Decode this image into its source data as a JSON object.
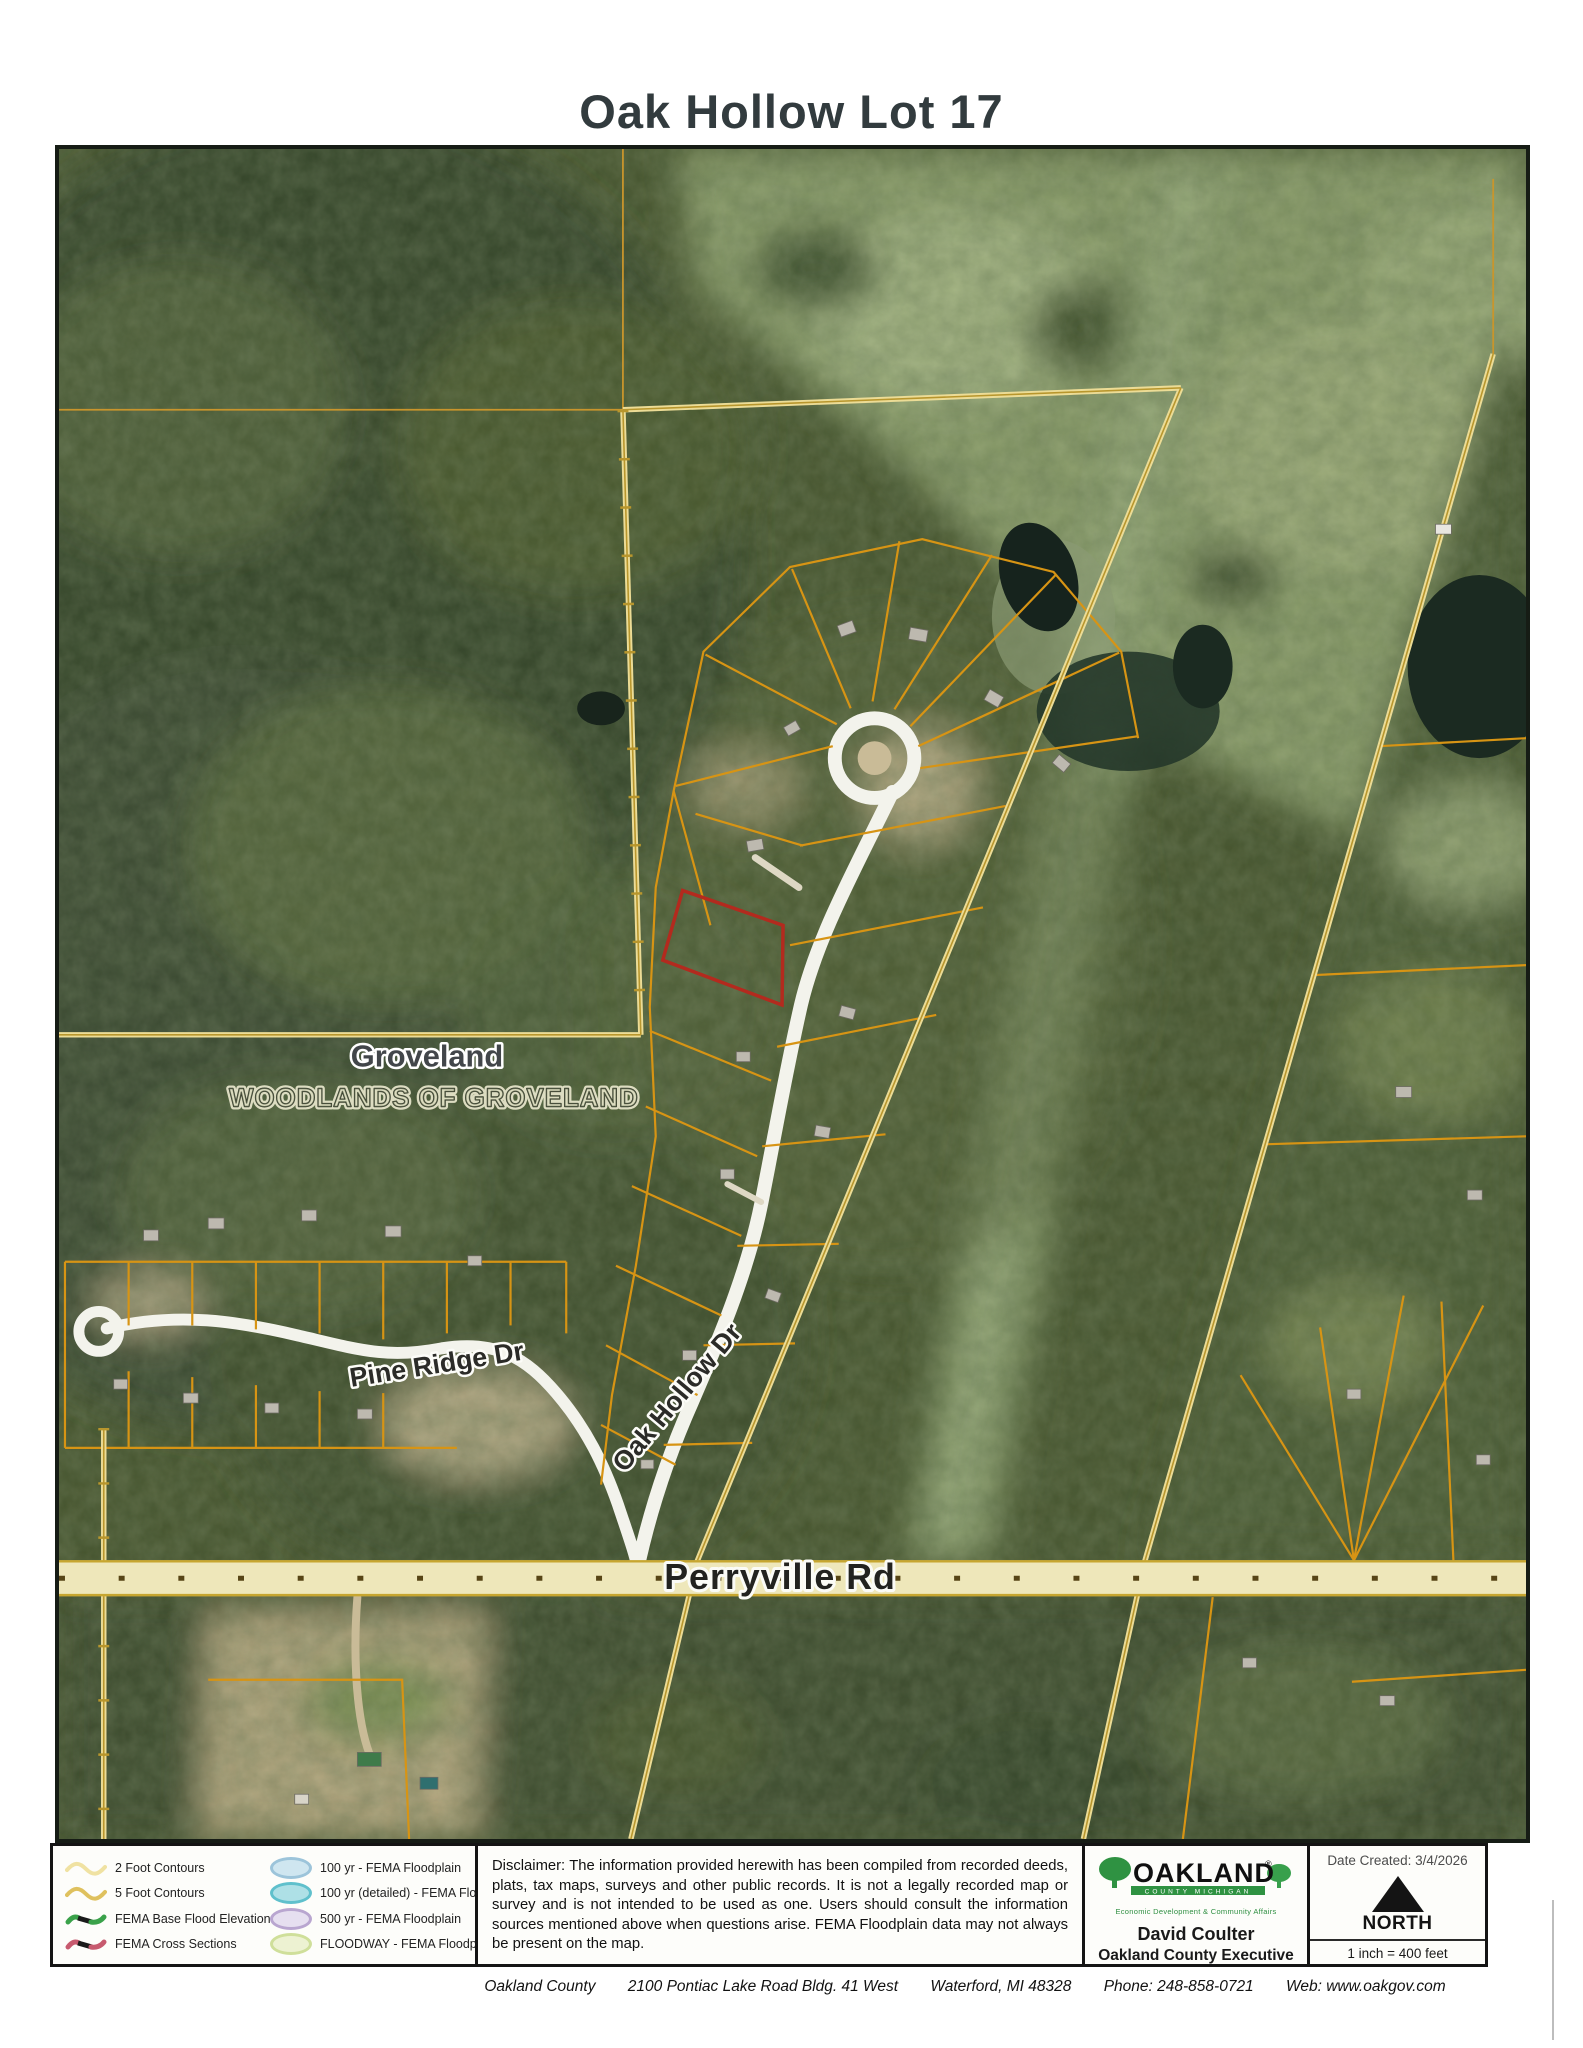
{
  "title": "Oak Hollow Lot 17",
  "map": {
    "labels": {
      "community": "Groveland",
      "subdivision": "WOODLANDS OF GROVELAND",
      "pine_ridge": "Pine Ridge Dr",
      "oak_hollow": "Oak Hollow Dr",
      "perryville": "Perryville Rd"
    },
    "highlight_color": "#b32a1e",
    "parcel_line_color": "#d79414",
    "boundary_color": "#ead98f"
  },
  "legend": {
    "items_left": [
      {
        "label": "2 Foot Contours",
        "icon": "contour-wave-icon",
        "color": "#f0e2a2"
      },
      {
        "label": "5 Foot Contours",
        "icon": "contour-wave-icon",
        "color": "#dfc15e"
      },
      {
        "label": "FEMA Base Flood Elevations",
        "icon": "zigzag-icon",
        "color": "#3aa24a"
      },
      {
        "label": "FEMA Cross Sections",
        "icon": "zigzag-icon",
        "color": "#c75a6e"
      }
    ],
    "items_right": [
      {
        "label": "100 yr - FEMA Floodplain",
        "icon": "ellipse-icon",
        "color": "#b5d9e9"
      },
      {
        "label": "100 yr (detailed) - FEMA Floodplain",
        "icon": "ellipse-icon",
        "color": "#8fd3dc"
      },
      {
        "label": "500 yr - FEMA Floodplain",
        "icon": "ellipse-icon",
        "color": "#ddd3ea"
      },
      {
        "label": "FLOODWAY - FEMA Floodplain",
        "icon": "ellipse-icon",
        "color": "#e9efcc"
      }
    ]
  },
  "disclaimer": "Disclaimer:  The information provided herewith has been compiled from recorded deeds, plats, tax maps, surveys and other public records.  It is not a legally recorded map or survey and is not intended to be used as one.  Users should consult the information sources mentioned above when questions arise. FEMA Floodplain data may not always be present on the map.",
  "agency": {
    "logo_text": "OAKLAND",
    "logo_subtext": "COUNTY MICHIGAN",
    "logo_registered": "®",
    "logo_tagline": "Economic Development & Community Affairs",
    "executive_name": "David Coulter",
    "executive_title": "Oakland County Executive"
  },
  "info_box": {
    "date_created": "Date Created: 3/4/2026",
    "north_label": "NORTH",
    "scale_text": "1 inch = 400 feet"
  },
  "footer": {
    "org": "Oakland County",
    "address": "2100 Pontiac Lake Road  Bldg. 41 West",
    "city": "Waterford, MI 48328",
    "phone": "Phone: 248-858-0721",
    "web": "Web: www.oakgov.com"
  }
}
